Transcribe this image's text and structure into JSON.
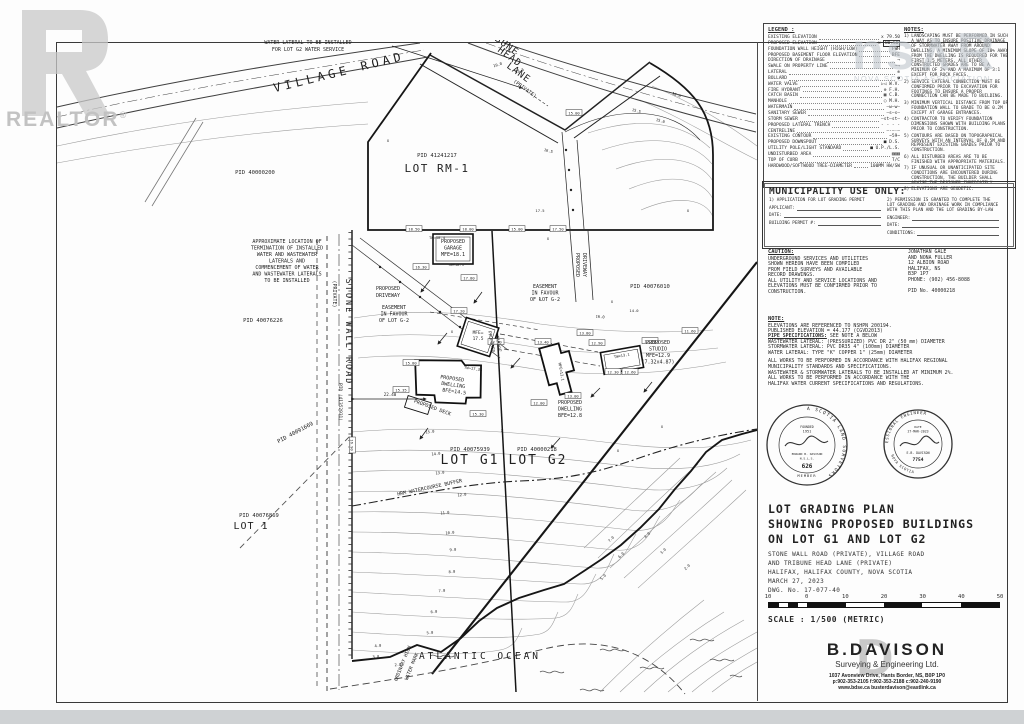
{
  "watermarks": {
    "realtor_word": "REALTOR",
    "reg": "®",
    "nsar": "ns∧R",
    "nsar_caption": "NOVA SCOTIA ASSOCIATION"
  },
  "legend": {
    "title": "LEGEND :",
    "items": [
      {
        "label": "EXISTING ELEVATION",
        "sym": "x 79.50"
      },
      {
        "label": "PROPOSED ELEVATION",
        "sym": "x 80.50",
        "boxed": true
      },
      {
        "label": "FOUNDATION WALL HEIGHT (HIGH/LOW)",
        "sym": "FWH"
      },
      {
        "label": "PROPOSED BASEMENT FLOOR ELEVATION",
        "sym": "BFE"
      },
      {
        "label": "DIRECTION OF DRAINAGE",
        "sym": "→"
      },
      {
        "label": "SWALE ON PROPERTY LINE",
        "sym": "~→"
      },
      {
        "label": "LATERAL",
        "sym": "⊗"
      },
      {
        "label": "BOLLARD",
        "sym": "●"
      },
      {
        "label": "WATER VALVE",
        "sym": "▷◁ W.V."
      },
      {
        "label": "FIRE HYDRANT",
        "sym": "⊕ F.H."
      },
      {
        "label": "CATCH BASIN",
        "sym": "▦ C.B."
      },
      {
        "label": "MANHOLE",
        "sym": "○ M.H."
      },
      {
        "label": "WATERMAIN",
        "sym": "—w—w—"
      },
      {
        "label": "SANITARY SEWER",
        "sym": "—s—s—"
      },
      {
        "label": "STORM SEWER",
        "sym": "—st—st—"
      },
      {
        "label": "PROPOSED LATERAL TRENCH",
        "sym": "- - - -"
      },
      {
        "label": "CENTRELINE",
        "sym": "—·—·—"
      },
      {
        "label": "EXISTING CONTOUR",
        "sym": "~59~"
      },
      {
        "label": "PROPOSED DOWNSPOUT",
        "sym": "■ D.S."
      },
      {
        "label": "UTILITY POLE/LIGHT STANDARD",
        "sym": "■ U.P./L.S."
      },
      {
        "label": "UNDISTURBED AREA",
        "sym": "▨▨▨"
      },
      {
        "label": "TOP OF CURB",
        "sym": "T/C"
      },
      {
        "label": "HARDWOOD/SOFTWOOD TREE-DIAMETER",
        "sym": "100MM HW/SW"
      }
    ]
  },
  "notes_panel": {
    "title": "NOTES:",
    "items": [
      "LANDSCAPING MUST BE PERFORMED IN SUCH A WAY AS TO ENSURE POSITIVE DRAINAGE OF STORMWATER AWAY FROM AROUND DWELLING. A MINIMUM SLOPE OF 10% AWAY FROM THE DWELLING IS REQUIRED FOR THE FIRST 1.5 METERS. ALL OTHER CONSTRUCTED GRADES ARE TO BE A MINIMUM OF 2% AND A MAXIMUM OF 3:1 EXCEPT FOR ROCK FACES.",
      "SERVICE LATERAL CONNECTION MUST BE CONFIRMED PRIOR TO EXCAVATION FOR FOOTINGS TO ENSURE A PROPER CONNECTION CAN BE MADE TO BUILDING.",
      "MINIMUM VERTICAL DISTANCE FROM TOP OF FOUNDATION WALL TO GRADE TO BE 0.2M EXCEPT AT GARAGE ENTRANCES.",
      "CONTRACTOR TO VERIFY FOUNDATION DIMENSIONS SHOWN WITH BUILDING PLANS PRIOR TO CONSTRUCTION.",
      "CONTOURS ARE BASED ON TOPOGRAPHICAL SURVEYS WITH AN INTERVAL OF 0.5M AND REPRESENT EXISTING GRADES PRIOR TO CONSTRUCTION.",
      "ALL DISTURBED AREAS ARE TO BE FINISHED WITH APPROPRIATE MATERIALS.",
      "IF UNUSUAL OR UNANTICIPATED SITE CONDITIONS ARE ENCOUNTERED DURING CONSTRUCTION, THE BUILDER SHALL ADVISE THE DESIGNER IMMEDIATELY.",
      "ELEVATIONS ARE GEODETIC."
    ]
  },
  "municipality": {
    "title": "MUNICIPALITY USE ONLY:",
    "col1_heading": "1) APPLICATION FOR LOT GRADING PERMIT",
    "col1_fields": [
      "APPLICANT:",
      "DATE:",
      "BUILDING PERMIT #:"
    ],
    "col2_heading": "2) PERMISSION IS GRANTED TO COMPLETE THE LOT GRADING AND DRAINAGE WORK IN COMPLIANCE WITH THIS PLAN AND THE LOT GRADING BY-LAW",
    "col2_fields": [
      "ENGINEER:",
      "DATE:",
      "CONDITIONS:"
    ]
  },
  "caution": {
    "title": "CAUTION:",
    "lines": [
      "UNDERGROUND SERVICES AND UTILITIES",
      "SHOWN HEREON HAVE BEEN COMPILED",
      "FROM FIELD SURVEYS AND AVAILABLE",
      "RECORD DRAWINGS.",
      "ALL UTILITY AND SERVICE LOCATIONS AND",
      "ELEVATIONS MUST BE CONFIRMED PRIOR TO",
      "CONSTRUCTION."
    ]
  },
  "owner": {
    "lines": [
      "JONATHAN GALE",
      "AND NONA FULLER",
      "12 ALBION ROAD",
      "HALIFAX, NS",
      "B3P 1P7",
      "PHONE: (902) 456-8088"
    ],
    "pid": "PID No. 40000218"
  },
  "note_sec": {
    "title": "NOTE:",
    "lines": [
      "ELEVATIONS ARE REFERENCED TO NSHPN 200194.",
      "PUBLISHED ELEVATION = 44.177 (CGVD2013)"
    ]
  },
  "pipe": {
    "title": "PIPE SPECIFICATIONS:",
    "intro": " SEE NOTE A BELOW",
    "lines": [
      "WASTEWATER LATERAL: (PRESSURIZED) PVC DR 2\" (50 mm) DIAMETER",
      "STORMWATER LATERAL: PVC DR35 4\" (100mm) DIAMETER",
      "WATER LATERAL: TYPE \"K\" COPPER 1\" (25mm) DIAMETER"
    ],
    "para": [
      "ALL WORKS TO BE PERFORMED IN ACCORDANCE WITH HALIFAX REGIONAL",
      "MUNICIPALITY STANDARDS AND SPECIFICATIONS.",
      "WASTEWATER & STORMWATER LATERALS TO BE INSTALLED AT MINIMUM 2%.",
      "ALL WORKS TO BE PERFORMED IN ACCORDANCE WITH THE",
      "HALIFAX WATER CURRENT SPECIFICATIONS AND REGULATIONS."
    ]
  },
  "seals": {
    "surveyor": {
      "ring": "THE ASSOCIATION OF NOVA SCOTIA LAND SURVEYORS",
      "founded": "FOUNDED",
      "year": "1951",
      "name": "EDWARD B. DAVISON",
      "desig": "N.S.L.S.",
      "number": "626",
      "member": "MEMBER"
    },
    "engineer": {
      "ring_top": "REGISTERED PROFESSIONAL ENGINEER",
      "ring_bottom": "PROVINCE OF NOVA SCOTIA",
      "date_label": "DATE",
      "date": "27-MAR-2023",
      "name": "E.B. DAVISON",
      "number": "7754"
    }
  },
  "title_block": {
    "line1": "LOT GRADING PLAN",
    "line2": "SHOWING PROPOSED BUILDINGS",
    "line3": "ON LOT G1 AND LOT G2",
    "sub": [
      "STONE WALL ROAD (PRIVATE), VILLAGE ROAD",
      "AND TRIBUNE HEAD LANE (PRIVATE)",
      "HALIFAX, HALIFAX COUNTY, NOVA SCOTIA",
      "MARCH 27, 2023",
      "DWG. No. 17-077-40"
    ]
  },
  "scale": {
    "ticks": [
      "10",
      "0",
      "10",
      "20",
      "30",
      "40",
      "50"
    ],
    "label": "SCALE : 1/500 (METRIC)"
  },
  "firm": {
    "big_d": "D",
    "name": "B.DAVISON",
    "tag": "Surveying & Engineering Ltd.",
    "addr1": "1037 Avonview Drive, Hants Border, NS, B0P 1P0",
    "addr2": "p:902-353-2105 f:902-353-2188 c:902-240-9190",
    "addr3": "www.bdse.ca    busterdavison@eastlink.ca"
  },
  "plan": {
    "labels": [
      {
        "t": "APPROXIMATE LOCATION OF",
        "x": 308,
        "y": 37,
        "s": 5
      },
      {
        "t": "WATER LATERAL TO BE INSTALLED",
        "x": 308,
        "y": 44,
        "s": 5
      },
      {
        "t": "FOR LOT G2 WATER SERVICE",
        "x": 308,
        "y": 51,
        "s": 5
      },
      {
        "t": "VILLAGE ROAD",
        "x": 340,
        "y": 76,
        "s": 12,
        "r": -14,
        "ls": 4
      },
      {
        "t": "TRIBUNE",
        "x": 497,
        "y": 42,
        "s": 9.5,
        "r": 36,
        "ls": 1
      },
      {
        "t": "HEAD",
        "x": 508,
        "y": 59,
        "s": 9.5,
        "r": 36,
        "ls": 1
      },
      {
        "t": "LANE",
        "x": 517,
        "y": 75,
        "s": 9.5,
        "r": 36,
        "ls": 1
      },
      {
        "t": "(PRIVATE)",
        "x": 524,
        "y": 90,
        "s": 5,
        "r": 36
      },
      {
        "t": "PID 40000200",
        "x": 255,
        "y": 174,
        "s": 5.5
      },
      {
        "t": "PID 41241217",
        "x": 437,
        "y": 157,
        "s": 5.5
      },
      {
        "t": "LOT RM-1",
        "x": 437,
        "y": 172,
        "s": 11,
        "ls": 1.5
      },
      {
        "t": "APPROXIMATE LOCATION OF",
        "x": 287,
        "y": 243,
        "s": 5
      },
      {
        "t": "TERMINATION OF INSTALLED",
        "x": 287,
        "y": 249.5,
        "s": 5
      },
      {
        "t": "WATER AND WASTEWATER",
        "x": 287,
        "y": 256,
        "s": 5
      },
      {
        "t": "LATERALS AND",
        "x": 287,
        "y": 262.5,
        "s": 5
      },
      {
        "t": "COMMENCEMENT OF WATER",
        "x": 287,
        "y": 269,
        "s": 5
      },
      {
        "t": "AND WASTEWATER LATERALS",
        "x": 287,
        "y": 275.5,
        "s": 5
      },
      {
        "t": "TO BE INSTALLED",
        "x": 287,
        "y": 282,
        "s": 5
      },
      {
        "t": "PID 40076226",
        "x": 263,
        "y": 322,
        "s": 5.5
      },
      {
        "t": "STONE WALL ROAD",
        "x": 346,
        "y": 332,
        "s": 8.5,
        "r": 90,
        "ls": 2
      },
      {
        "t": "(PRIVATE)",
        "x": 333,
        "y": 294,
        "s": 5,
        "r": 90
      },
      {
        "t": "PID (41352931)",
        "x": 339,
        "y": 402,
        "s": 4.5,
        "r": 90
      },
      {
        "t": "PID 40091669",
        "x": 296,
        "y": 434,
        "s": 5.5,
        "r": -28
      },
      {
        "t": "PROPOSED",
        "x": 388,
        "y": 290,
        "s": 5
      },
      {
        "t": "DRIVEWAY",
        "x": 388,
        "y": 297,
        "s": 5
      },
      {
        "t": "EASEMENT",
        "x": 394,
        "y": 309,
        "s": 5
      },
      {
        "t": "IN FAVOUR",
        "x": 394,
        "y": 315.5,
        "s": 5
      },
      {
        "t": "OF LOT G-2",
        "x": 394,
        "y": 322,
        "s": 5
      },
      {
        "t": "PROPOSED",
        "x": 453,
        "y": 243,
        "s": 5
      },
      {
        "t": "GARAGE",
        "x": 453,
        "y": 249.5,
        "s": 5
      },
      {
        "t": "MFE=18.1",
        "x": 453,
        "y": 256,
        "s": 5
      },
      {
        "t": "TW=18.4",
        "x": 437,
        "y": 239,
        "s": 3.8
      },
      {
        "t": "TW=18.1",
        "x": 456,
        "y": 266,
        "s": 3.8
      },
      {
        "t": "EASEMENT",
        "x": 545,
        "y": 288,
        "s": 5
      },
      {
        "t": "IN FAVOUR",
        "x": 545,
        "y": 294.5,
        "s": 5
      },
      {
        "t": "OF LOT G-2",
        "x": 545,
        "y": 301,
        "s": 5
      },
      {
        "t": "PROPOSED",
        "x": 576,
        "y": 265,
        "s": 5,
        "r": 90
      },
      {
        "t": "DRIVEWAY",
        "x": 583,
        "y": 265,
        "s": 5,
        "r": 90
      },
      {
        "t": "PID 40076010",
        "x": 650,
        "y": 288,
        "s": 5.5
      },
      {
        "t": "MFE=",
        "x": 478,
        "y": 334,
        "s": 4.5
      },
      {
        "t": "17.5",
        "x": 478,
        "y": 340,
        "s": 4.5
      },
      {
        "t": "PROPOSED",
        "x": 490,
        "y": 342,
        "s": 4.5,
        "r": 80
      },
      {
        "t": "GARAGE",
        "x": 497,
        "y": 344,
        "s": 4.5,
        "r": 80
      },
      {
        "t": "PROPOSED",
        "x": 452,
        "y": 380,
        "s": 5,
        "r": 8
      },
      {
        "t": "DWELLING",
        "x": 453,
        "y": 386.5,
        "s": 5,
        "r": 8
      },
      {
        "t": "BFE=14.5",
        "x": 454,
        "y": 393,
        "s": 5,
        "r": 8
      },
      {
        "t": "TW=17.35",
        "x": 473,
        "y": 370,
        "s": 3.8,
        "r": 8
      },
      {
        "t": "PROPOSED DECK",
        "x": 432,
        "y": 409,
        "s": 5,
        "r": 20
      },
      {
        "t": "22.40",
        "x": 390,
        "y": 396,
        "s": 4.2
      },
      {
        "t": "PROPOSED",
        "x": 570,
        "y": 404,
        "s": 5
      },
      {
        "t": "DWELLING",
        "x": 570,
        "y": 410.5,
        "s": 5
      },
      {
        "t": "BFE=12.8",
        "x": 570,
        "y": 417,
        "s": 5
      },
      {
        "t": "MFE=13.1",
        "x": 560,
        "y": 372,
        "s": 3.8,
        "r": 80
      },
      {
        "t": "PROPOSED",
        "x": 658,
        "y": 344,
        "s": 5
      },
      {
        "t": "STUDIO",
        "x": 658,
        "y": 350.5,
        "s": 5
      },
      {
        "t": "MFE=12.9",
        "x": 658,
        "y": 357,
        "s": 5
      },
      {
        "t": "(7.32x4.87)",
        "x": 658,
        "y": 363.5,
        "s": 5
      },
      {
        "t": "TW=13.1",
        "x": 622,
        "y": 357,
        "s": 3.8,
        "r": -10
      },
      {
        "t": "PID 40075939",
        "x": 470,
        "y": 451,
        "s": 5.5
      },
      {
        "t": "LOT G1",
        "x": 470,
        "y": 464,
        "s": 13,
        "ls": 2
      },
      {
        "t": "PID 40000218",
        "x": 537,
        "y": 451,
        "s": 5.5
      },
      {
        "t": "LOT G2",
        "x": 538,
        "y": 464,
        "s": 13,
        "ls": 2
      },
      {
        "t": "HRM WATERCOURSE BUFFER",
        "x": 430,
        "y": 489,
        "s": 5,
        "r": -12
      },
      {
        "t": "PID 40076869",
        "x": 259,
        "y": 517,
        "s": 5.5
      },
      {
        "t": "LOT 1",
        "x": 251,
        "y": 529,
        "s": 10,
        "ls": 1
      },
      {
        "t": "ATLANTIC OCEAN",
        "x": 480,
        "y": 659,
        "s": 9.5,
        "ls": 3
      },
      {
        "t": "ORDINARY HIGH",
        "x": 404,
        "y": 664,
        "s": 4.8,
        "r": -68
      },
      {
        "t": "WATER MARK",
        "x": 413,
        "y": 667,
        "s": 4.8,
        "r": -68
      }
    ],
    "contour_labels": [
      {
        "t": "19.0",
        "x": 498,
        "y": 66,
        "r": -18
      },
      {
        "t": "18.5",
        "x": 520,
        "y": 72,
        "r": -18
      },
      {
        "t": "18.0",
        "x": 676,
        "y": 96,
        "r": 20
      },
      {
        "t": "16.5",
        "x": 548,
        "y": 152,
        "r": 15
      },
      {
        "t": "17.5",
        "x": 540,
        "y": 212
      },
      {
        "t": "15.5",
        "x": 636,
        "y": 112,
        "r": 15
      },
      {
        "t": "15.0",
        "x": 660,
        "y": 122,
        "r": 15
      },
      {
        "t": "16.0",
        "x": 600,
        "y": 318,
        "r": 5
      },
      {
        "t": "14.0",
        "x": 634,
        "y": 312
      },
      {
        "t": "15.0",
        "x": 430,
        "y": 433,
        "r": -5
      },
      {
        "t": "14.0",
        "x": 436,
        "y": 455,
        "r": -5
      },
      {
        "t": "13.0",
        "x": 440,
        "y": 474,
        "r": -5
      },
      {
        "t": "12.0",
        "x": 462,
        "y": 496,
        "r": -5
      },
      {
        "t": "11.0",
        "x": 445,
        "y": 514,
        "r": -5
      },
      {
        "t": "10.0",
        "x": 450,
        "y": 534,
        "r": -5
      },
      {
        "t": "9.0",
        "x": 453,
        "y": 551,
        "r": -5
      },
      {
        "t": "8.0",
        "x": 452,
        "y": 573,
        "r": -5
      },
      {
        "t": "7.0",
        "x": 442,
        "y": 592,
        "r": -5
      },
      {
        "t": "6.0",
        "x": 434,
        "y": 613,
        "r": -5
      },
      {
        "t": "5.0",
        "x": 430,
        "y": 634,
        "r": -5
      },
      {
        "t": "4.0",
        "x": 378,
        "y": 647,
        "r": -5
      },
      {
        "t": "3.0",
        "x": 376,
        "y": 658,
        "r": -5
      },
      {
        "t": "2.0",
        "x": 398,
        "y": 666,
        "r": -5
      },
      {
        "t": "7.0",
        "x": 612,
        "y": 540,
        "r": -45
      },
      {
        "t": "6.0",
        "x": 622,
        "y": 556,
        "r": -45
      },
      {
        "t": "5.0",
        "x": 604,
        "y": 578,
        "r": -45
      },
      {
        "t": "4.0",
        "x": 648,
        "y": 536,
        "r": -45
      },
      {
        "t": "3.0",
        "x": 664,
        "y": 552,
        "r": -45
      },
      {
        "t": "2.0",
        "x": 688,
        "y": 568,
        "r": -45
      }
    ],
    "boxed_elevations": [
      {
        "t": "18.50",
        "x": 414,
        "y": 229
      },
      {
        "t": "18.00",
        "x": 468,
        "y": 229
      },
      {
        "t": "15.00",
        "x": 517,
        "y": 229
      },
      {
        "t": "17.50",
        "x": 558,
        "y": 229
      },
      {
        "t": "15.00",
        "x": 574,
        "y": 113
      },
      {
        "t": "16.30",
        "x": 421,
        "y": 267
      },
      {
        "t": "17.80",
        "x": 469,
        "y": 278
      },
      {
        "t": "17.20",
        "x": 459,
        "y": 311
      },
      {
        "t": "15.80",
        "x": 411,
        "y": 363
      },
      {
        "t": "15.35",
        "x": 401,
        "y": 390
      },
      {
        "t": "15.30",
        "x": 478,
        "y": 414
      },
      {
        "t": "16.90",
        "x": 352,
        "y": 445,
        "r": 90
      },
      {
        "t": "13.40",
        "x": 543,
        "y": 342
      },
      {
        "t": "12.40",
        "x": 496,
        "y": 342
      },
      {
        "t": "12.00",
        "x": 539,
        "y": 403
      },
      {
        "t": "13.00",
        "x": 573,
        "y": 396
      },
      {
        "t": "13.80",
        "x": 585,
        "y": 333
      },
      {
        "t": "12.90",
        "x": 597,
        "y": 343
      },
      {
        "t": "12.30",
        "x": 613,
        "y": 372
      },
      {
        "t": "12.60",
        "x": 630,
        "y": 372
      },
      {
        "t": "13.60",
        "x": 650,
        "y": 341
      },
      {
        "t": "11.60",
        "x": 690,
        "y": 331
      }
    ],
    "x_marks": [
      [
        540,
        300
      ],
      [
        612,
        303
      ],
      [
        502,
        432
      ],
      [
        618,
        452
      ],
      [
        662,
        428
      ],
      [
        452,
        333
      ],
      [
        388,
        142
      ],
      [
        688,
        212
      ],
      [
        548,
        240
      ]
    ]
  }
}
